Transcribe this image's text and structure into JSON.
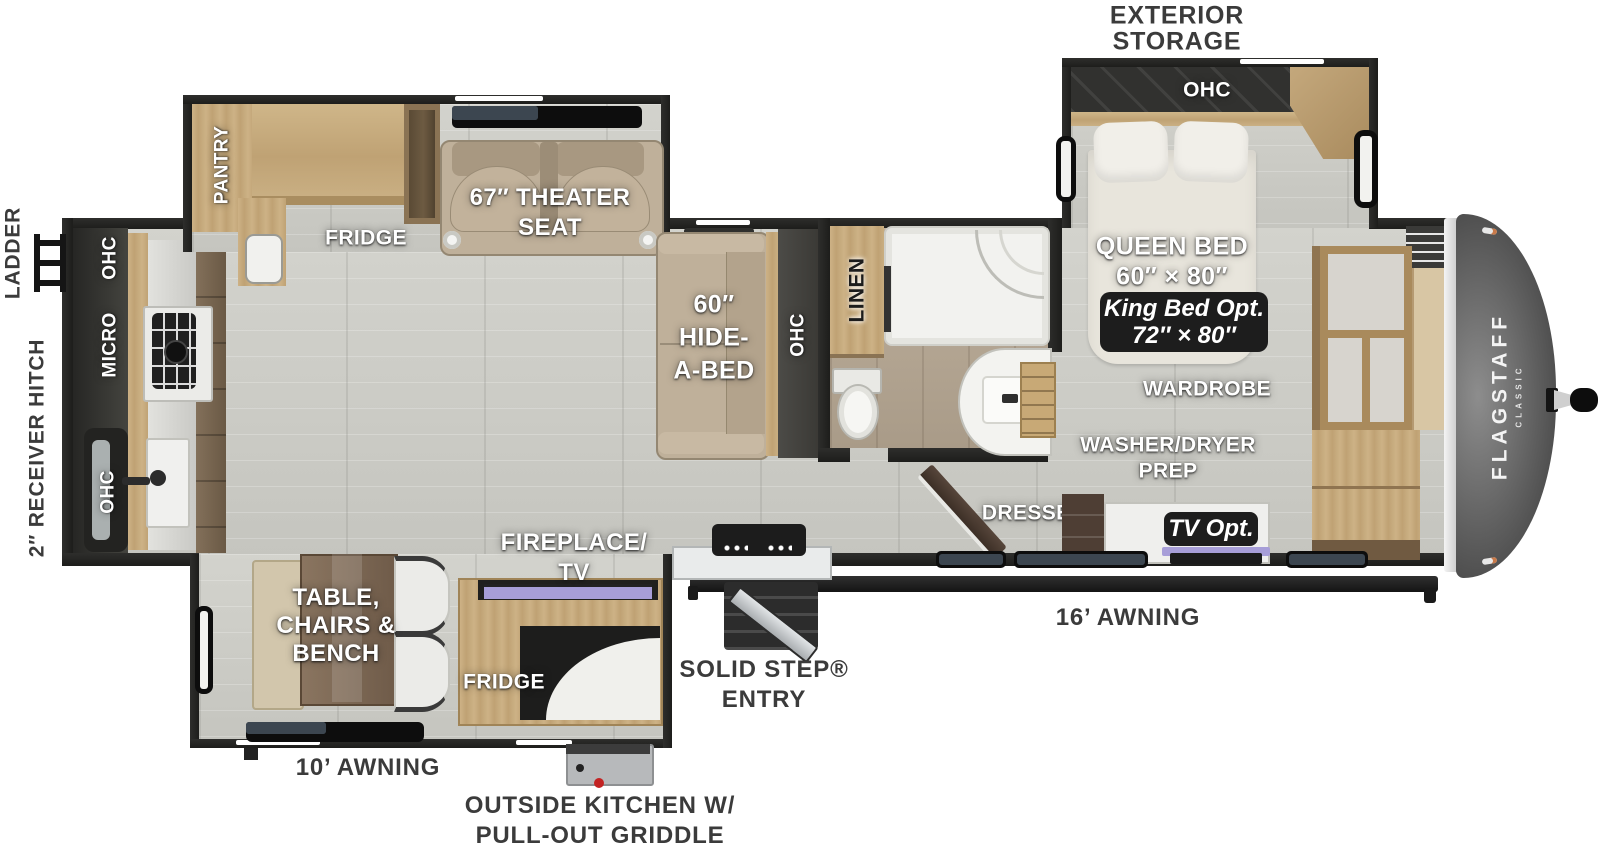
{
  "labels": {
    "exterior_storage": {
      "l1": "EXTERIOR",
      "l2": "STORAGE"
    },
    "ladder": "LADDER",
    "receiver_hitch": "2″ RECEIVER HITCH",
    "awning_16": "16’ AWNING",
    "awning_10": "10’ AWNING",
    "outside_kitchen": {
      "l1": "OUTSIDE KITCHEN W/",
      "l2": "PULL-OUT GRIDDLE"
    },
    "solid_step": {
      "l1": "SOLID STEP®",
      "l2": "ENTRY"
    }
  },
  "bedroom": {
    "ohc": "OHC",
    "queen": {
      "l1": "QUEEN BED",
      "l2": "60″ × 80″"
    },
    "king_opt": {
      "l1": "King Bed Opt.",
      "l2": "72″ × 80″"
    },
    "wardrobe": "WARDROBE",
    "washer_dryer": {
      "l1": "WASHER/DRYER",
      "l2": "PREP"
    },
    "tv_opt": "TV Opt.",
    "dresser": "DRESSER"
  },
  "bathroom": {
    "linen": "LINEN"
  },
  "living": {
    "hide_a_bed": {
      "l1": "60″",
      "l2": "HIDE-",
      "l3": "A-BED"
    },
    "sofa_ohc": "OHC",
    "theater": {
      "l1": "67″ THEATER",
      "l2": "SEAT"
    },
    "fridge": "FRIDGE",
    "pantry": "PANTRY",
    "fireplace": {
      "l1": "FIREPLACE/",
      "l2": "TV"
    },
    "dinette": {
      "l1": "TABLE,",
      "l2": "CHAIRS &",
      "l3": "BENCH"
    },
    "outside_fridge": "FRIDGE"
  },
  "kitchen": {
    "ohc_upper": "OHC",
    "micro": "MICRO",
    "ohc_lower": "OHC"
  },
  "brand": {
    "name": "FLAGSTAFF",
    "series": "CLASSIC"
  },
  "colors": {
    "wall": "#262626",
    "floor": "#cdcdc7",
    "wood": "#c4a87d",
    "tv_accent": "#a79ed8",
    "badge": "#1d1d1d"
  }
}
